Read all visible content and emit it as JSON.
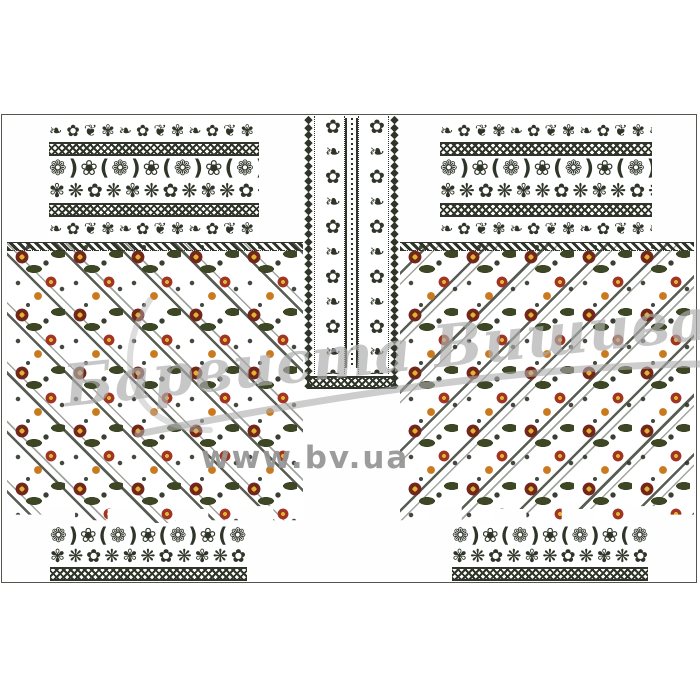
{
  "artwork": {
    "type": "embroidery-pattern-preview",
    "description_visible_elements": "vyshyvanka shirt embroidery layout: two sleeve border bands, central collar placket band, two diagonal floral body panels, two cuff bands"
  },
  "watermark": {
    "script_text": "Барвиста Вишиванка",
    "url_text": "www.bv.ua"
  },
  "colors": {
    "background": "#ffffff",
    "thread_dark": "#2f3529",
    "flower_maroon": "#73261b",
    "flower_red": "#a03526",
    "flower_orange": "#c97a1e",
    "flower_yellow": "#e2b42c",
    "leaf_green": "#3d4625",
    "frame_line": "#55554e",
    "watermark_gray": "#acacac"
  },
  "ornament": {
    "vine_row": "❧✿❦✾❧✿❦✾❧✿❦✾❧✿❦✾❧✿❦✾",
    "main_row_a": "❁)❀(❁)❀(❁)❀(❁)❀(❁)❀(",
    "main_row_b": "✾❋✿❋✾❋✿❋✾❋✿❋✾❋✿❋✾❋✿❋",
    "lace_column": "◆◆◆◆◆◆◆◆◆◆◆◆◆◆◆◆◆◆◆◆◆◆◆◆◆◆◆◆◆◆◆◆◆◆◆◆",
    "collar_column": "✿❧✿❧✿❧✿❧✿❧✿❧✿❧"
  }
}
